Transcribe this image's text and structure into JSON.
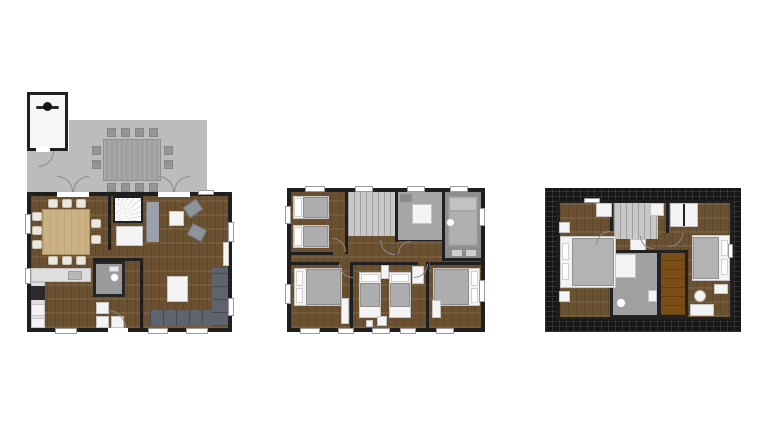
{
  "image_type": "floor-plan-set",
  "colors": {
    "background": "#ffffff",
    "wall": "#1f1f1f",
    "wood": "#6f5433",
    "wood_table": "#cbb183",
    "terrace": "#bcbcbc",
    "terrace_furniture": "#a0a0a0",
    "landing": "#c8c8c8",
    "tile_light": "#a6a6a6",
    "tile_dark": "#8e8e8e",
    "sofa_dark": "#5d646d",
    "sofa_light": "#9aa1a9",
    "bed_blanket": "#adadad",
    "furniture_white": "#f4f4f4",
    "stove_black": "#2a2a2a",
    "sauna_wood": "#7b4e15",
    "roof": "#161616"
  },
  "floors": [
    {
      "id": "ground-floor",
      "features": [
        "bike-shed",
        "terrace",
        "outdoor-dining-table-with-12-chairs",
        "double-french-doors",
        "dining-table-with-10-chairs",
        "kitchen-counter-with-stove-and-sink",
        "fan-staircase",
        "closet",
        "wc-with-toilet",
        "appliance-cupboards",
        "living-room",
        "corner-sofa",
        "two-armchairs",
        "side-table",
        "coffee-table",
        "sideboard",
        "entrance-door",
        "windows"
      ]
    },
    {
      "id": "first-floor",
      "features": [
        "twin-bedroom-top-left",
        "landing-with-staircase",
        "shower-room",
        "bathroom-with-tub",
        "double-bedroom-bottom-left",
        "twin-bedroom-bottom-middle",
        "double-bedroom-bottom-right",
        "hallway",
        "wardrobes",
        "windows"
      ]
    },
    {
      "id": "attic",
      "features": [
        "roof-tile-border",
        "double-bedroom-left",
        "landing-with-staircase",
        "closets",
        "bathroom-with-shower-and-toilet",
        "sauna",
        "double-bedroom-right",
        "dressing-table-with-stool"
      ]
    }
  ]
}
